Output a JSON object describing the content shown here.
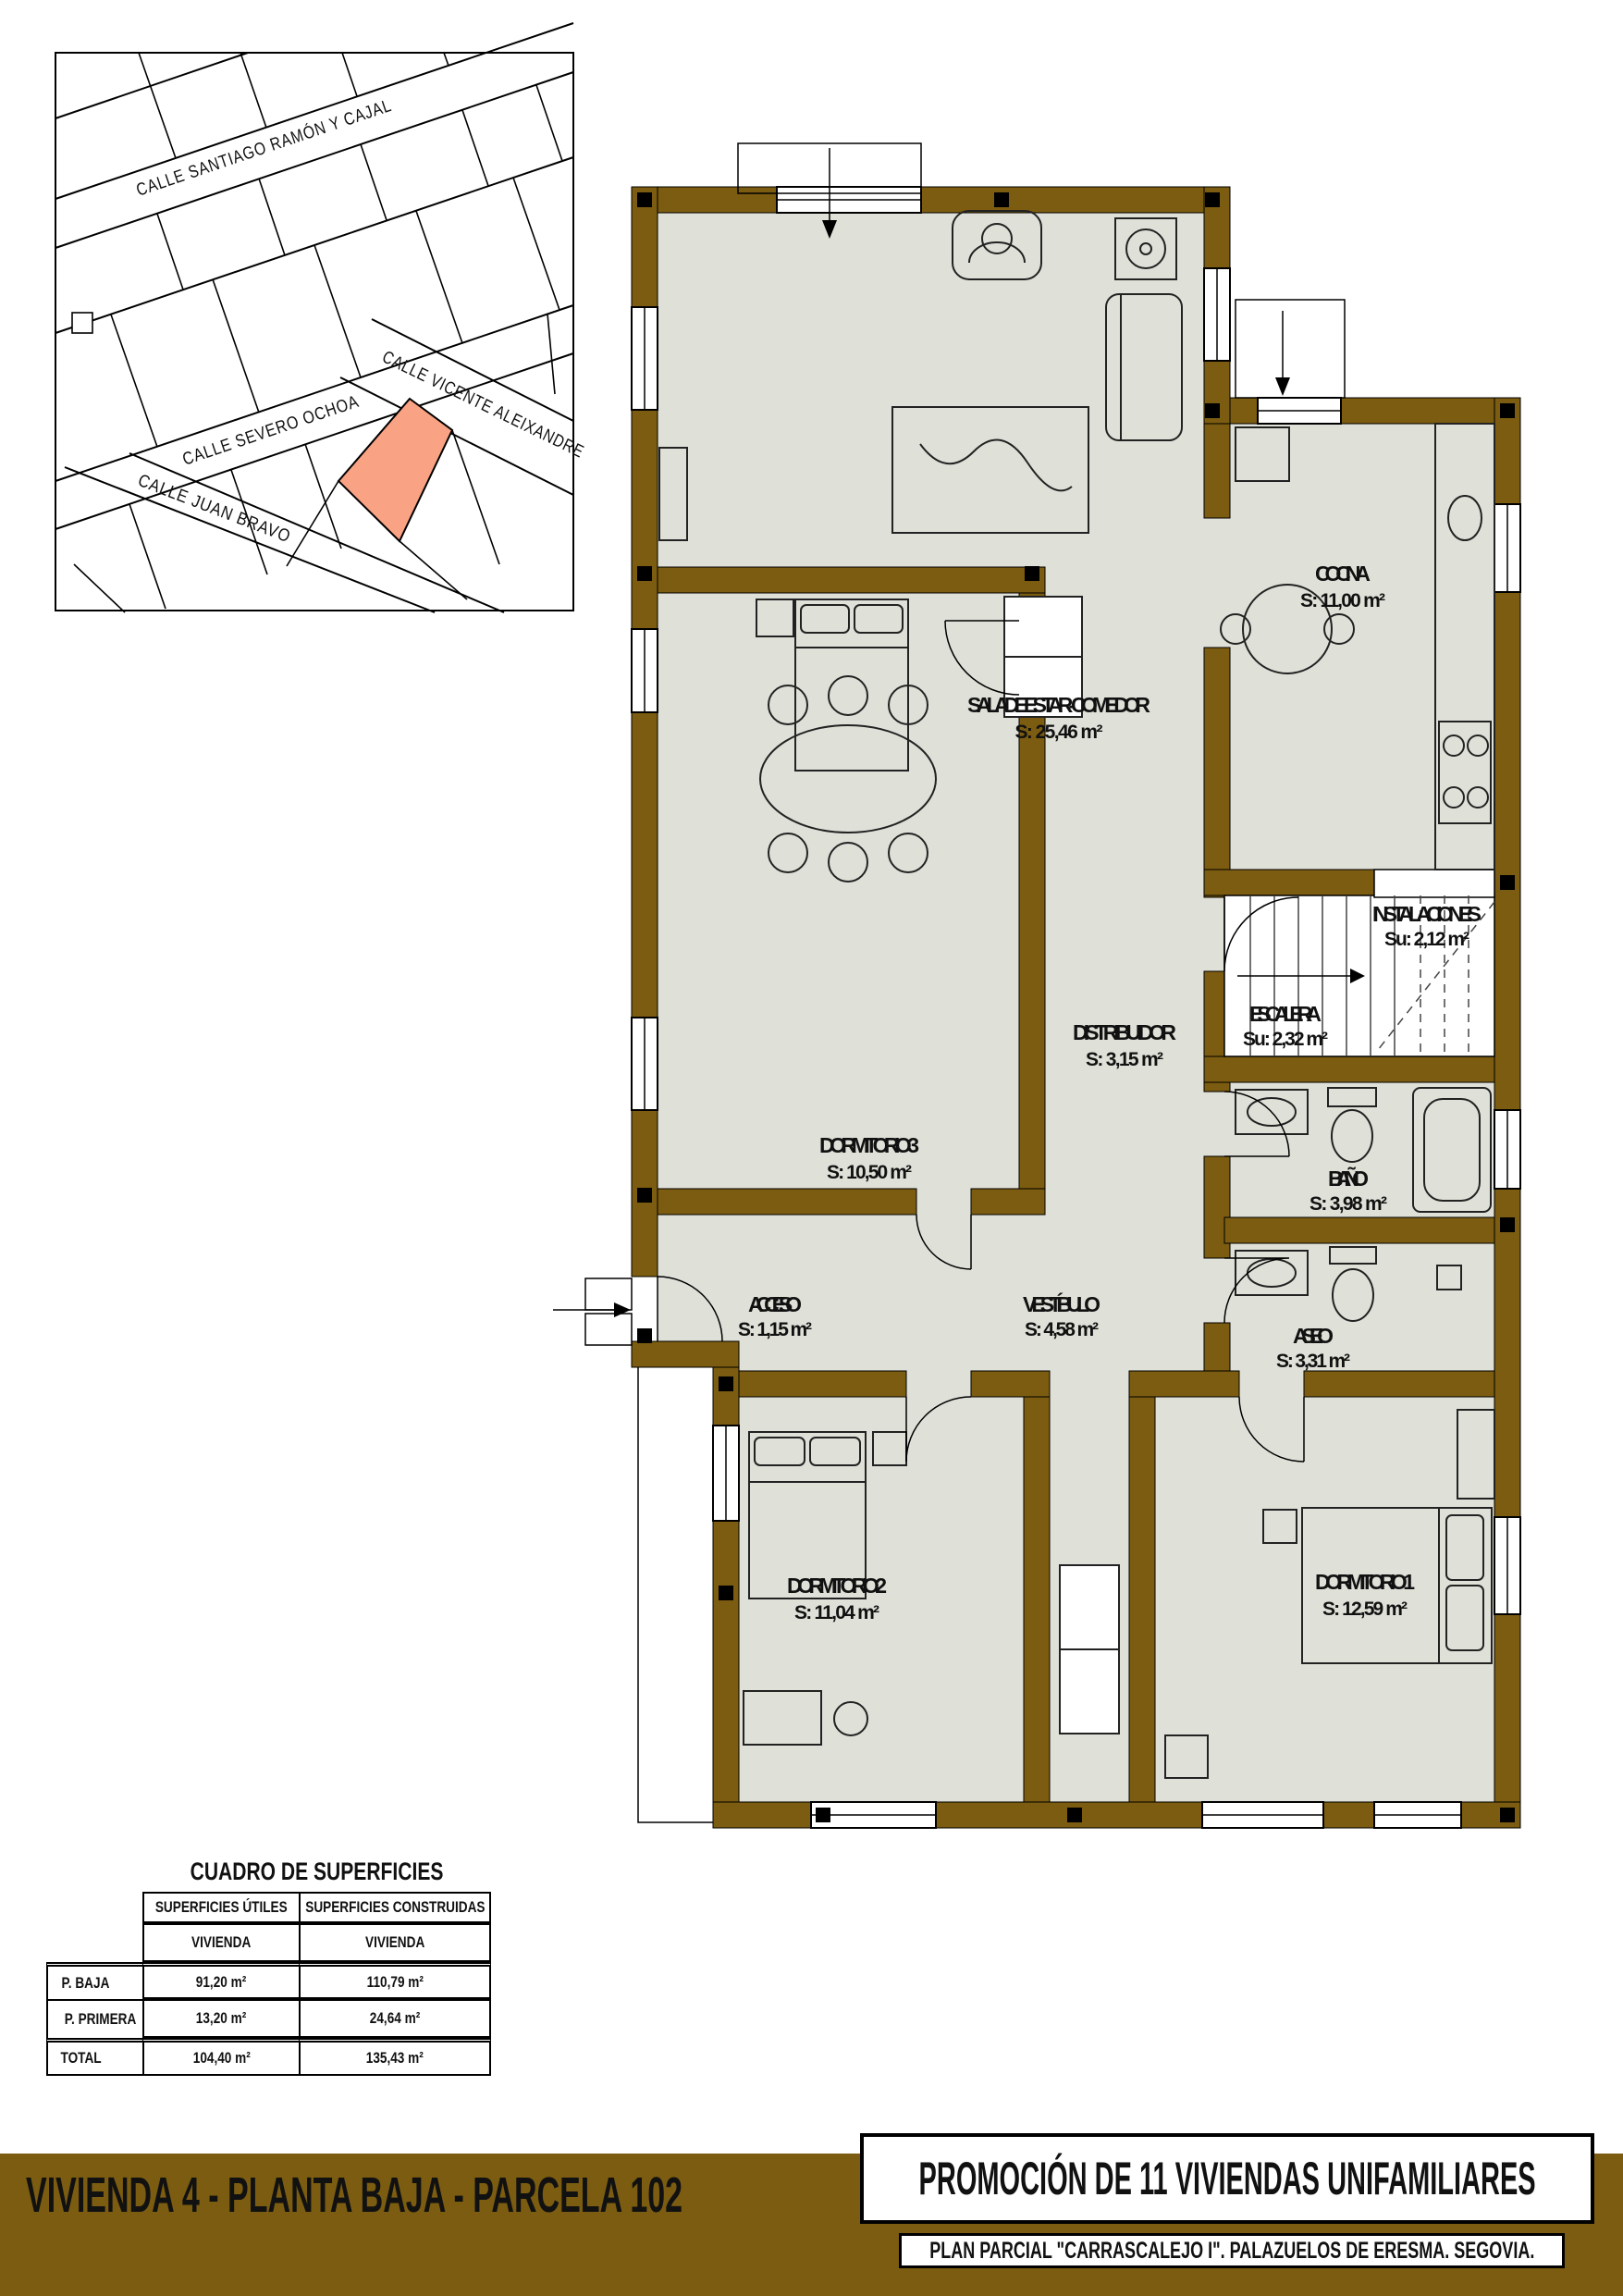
{
  "map": {
    "highlight_color": "#F9A284",
    "streets": [
      {
        "label": "CALLE SANTIAGO RAMÓN Y CAJAL"
      },
      {
        "label": "CALLE SEVERO OCHOA"
      },
      {
        "label": "CALLE VICENTE ALEIXANDRE"
      },
      {
        "label": "CALLE JUAN BRAVO"
      }
    ]
  },
  "plan": {
    "wall_color": "#7B5C10",
    "floor_color": "#DFE0D8",
    "rooms": [
      {
        "name": "SALA DE ESTAR - COMEDOR",
        "area": "S: 25,46 m²"
      },
      {
        "name": "COCINA",
        "area": "S: 11,00 m²"
      },
      {
        "name": "INSTALACIONES",
        "area": "Su: 2,12 m²"
      },
      {
        "name": "ESCALERA",
        "area": "Su: 2,32 m²"
      },
      {
        "name": "DISTRIBUIDOR",
        "area": "S: 3,15 m²"
      },
      {
        "name": "DORMITORIO 3",
        "area": "S: 10,50 m²"
      },
      {
        "name": "BAÑO",
        "area": "S: 3,98 m²"
      },
      {
        "name": "ACCESO",
        "area": "S: 1,15 m²"
      },
      {
        "name": "VESTÍBULO",
        "area": "S: 4,58 m²"
      },
      {
        "name": "ASEO",
        "area": "S: 3,31 m²"
      },
      {
        "name": "DORMITORIO 2",
        "area": "S: 11,04 m²"
      },
      {
        "name": "DORMITORIO 1",
        "area": "S: 12,59 m²"
      }
    ]
  },
  "table": {
    "title": "CUADRO DE SUPERFICIES",
    "col_headers": [
      "SUPERFICIES ÚTILES",
      "SUPERFICIES CONSTRUIDAS"
    ],
    "sub_headers": [
      "VIVIENDA",
      "VIVIENDA"
    ],
    "rows": [
      {
        "label": "P. BAJA",
        "utiles": "91,20 m²",
        "construidas": "110,79 m²"
      },
      {
        "label": "P. PRIMERA",
        "utiles": "13,20 m²",
        "construidas": "24,64 m²"
      },
      {
        "label": "TOTAL",
        "utiles": "104,40 m²",
        "construidas": "135,43 m²"
      }
    ]
  },
  "footer": {
    "left_title": "VIVIENDA 4 - PLANTA BAJA - PARCELA 102",
    "right_title": "PROMOCIÓN DE 11 VIVIENDAS UNIFAMILIARES",
    "right_subtitle": "PLAN PARCIAL \"CARRASCALEJO I\". PALAZUELOS DE ERESMA. SEGOVIA.",
    "bar_color": "#7B5C10"
  }
}
